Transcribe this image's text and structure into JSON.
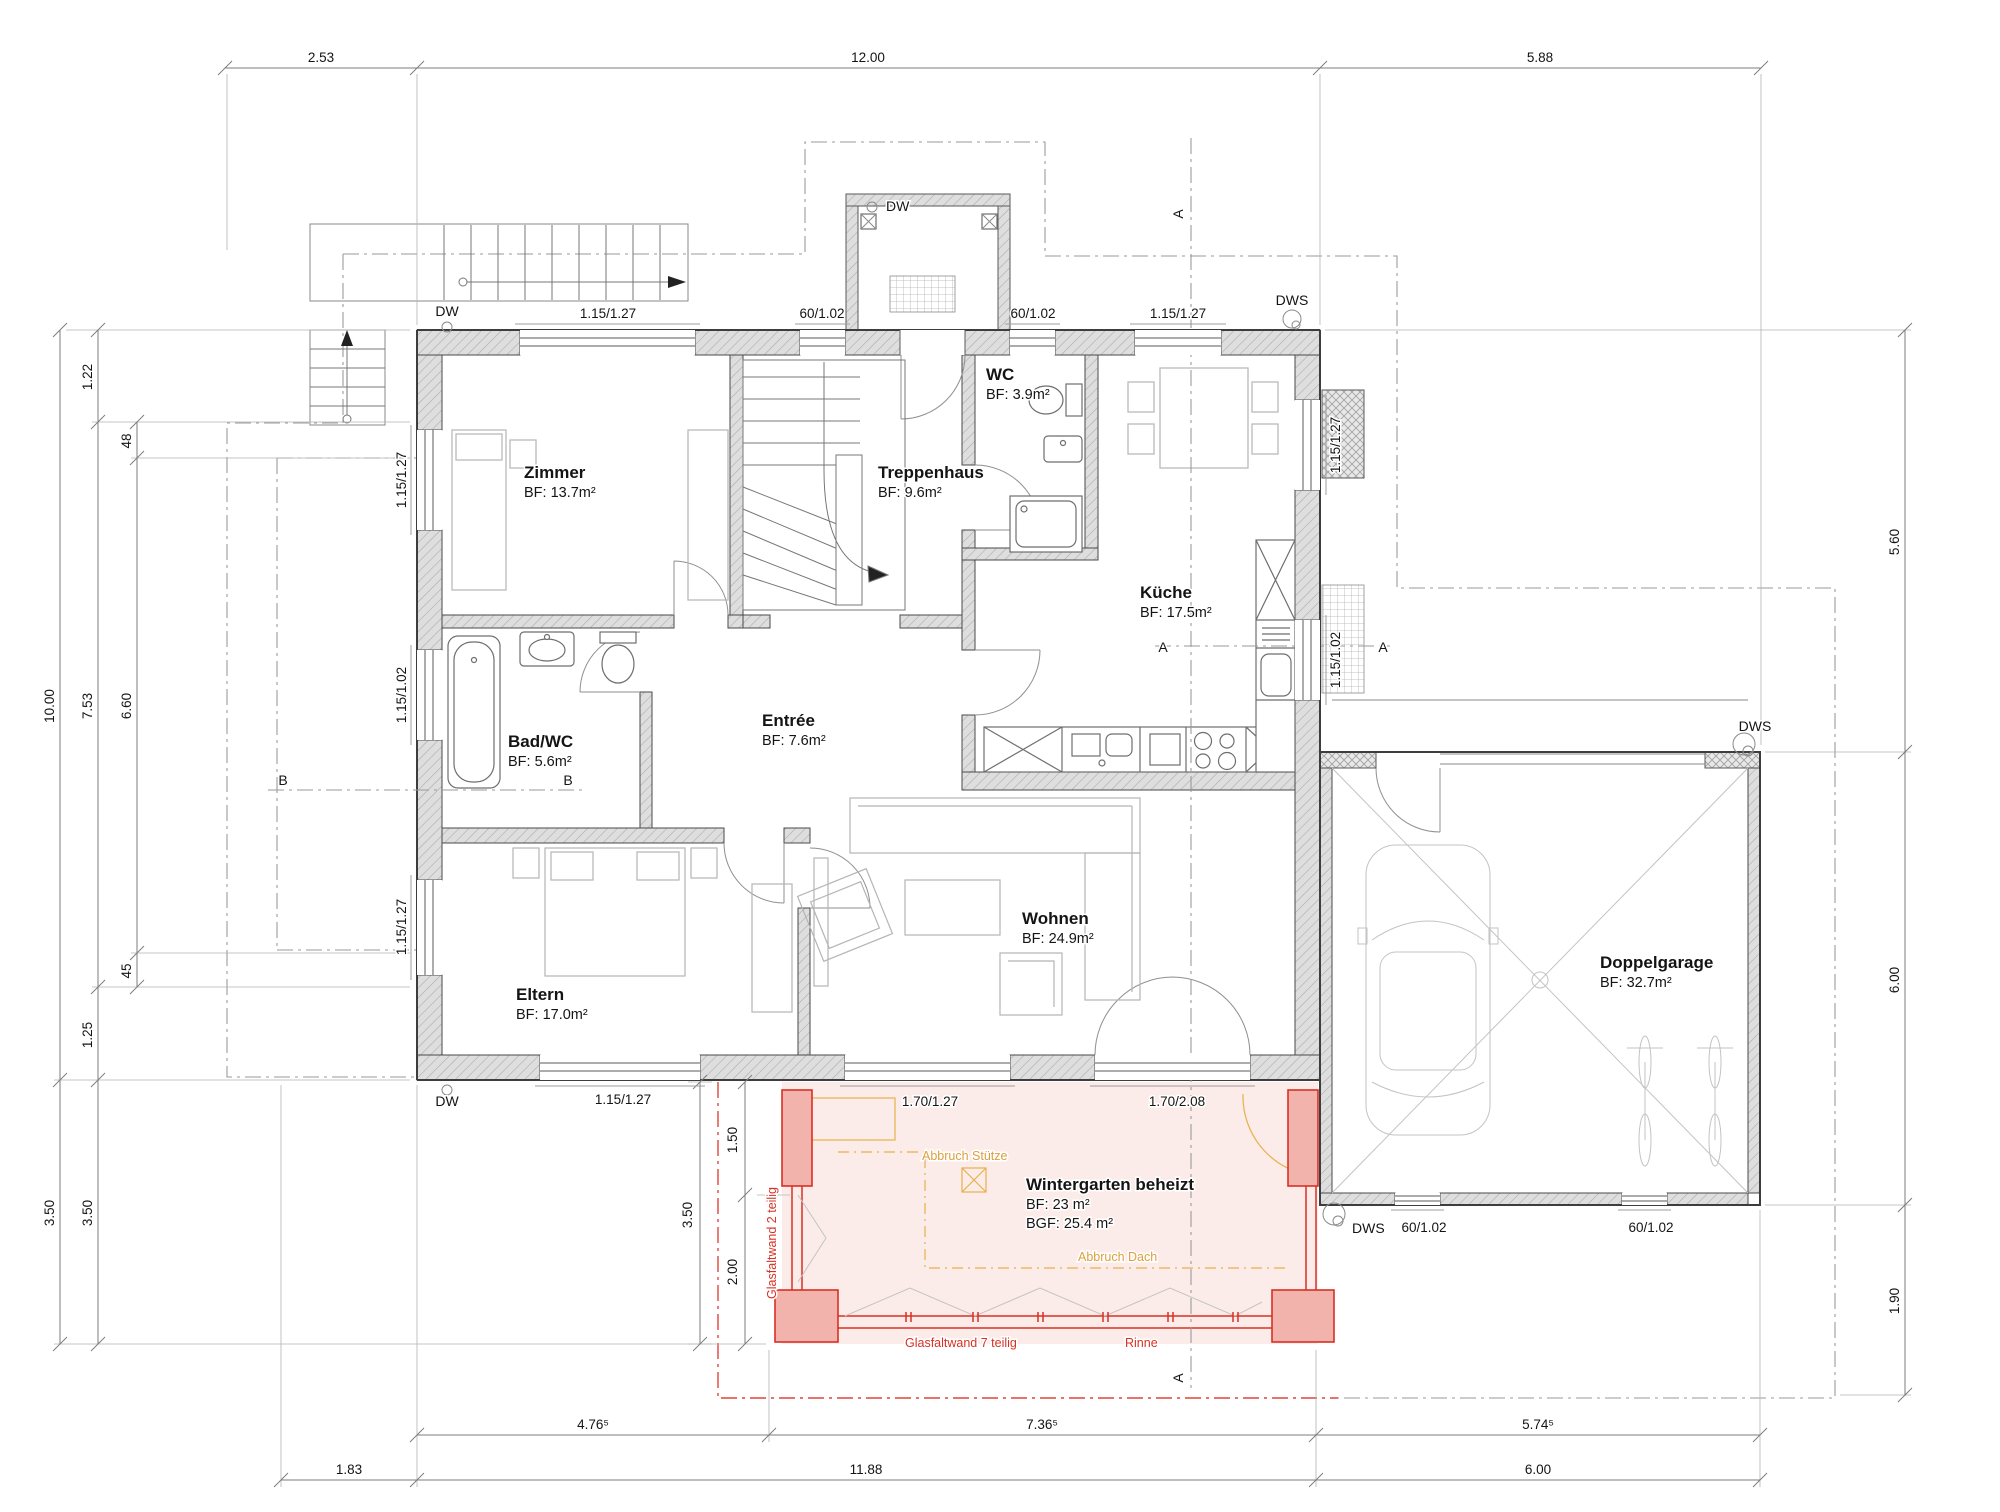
{
  "meta": {
    "drawing_type": "floor-plan",
    "language": "de"
  },
  "palette": {
    "background": "#ffffff",
    "line": "#7d7d7d",
    "wall_edge": "#3d3d3d",
    "text": "#141414",
    "accent_red": "#d93025",
    "accent_red_fill": "#f2b3ad",
    "accent_pink_fill": "#fceae7",
    "accent_orange": "#e7b04a"
  },
  "rooms": [
    {
      "id": "zimmer",
      "name": "Zimmer",
      "area": "BF: 13.7m²",
      "x": 524,
      "y": 478
    },
    {
      "id": "treppenhaus",
      "name": "Treppenhaus",
      "area": "BF: 9.6m²",
      "x": 878,
      "y": 478
    },
    {
      "id": "wc",
      "name": "WC",
      "area": "BF: 3.9m²",
      "x": 986,
      "y": 380
    },
    {
      "id": "kueche",
      "name": "Küche",
      "area": "BF: 17.5m²",
      "x": 1140,
      "y": 598
    },
    {
      "id": "bad-wc",
      "name": "Bad/WC",
      "area": "BF: 5.6m²",
      "x": 508,
      "y": 747
    },
    {
      "id": "entree",
      "name": "Entrée",
      "area": "BF: 7.6m²",
      "x": 762,
      "y": 726
    },
    {
      "id": "eltern",
      "name": "Eltern",
      "area": "BF: 17.0m²",
      "x": 516,
      "y": 1000
    },
    {
      "id": "wohnen",
      "name": "Wohnen",
      "area": "BF: 24.9m²",
      "x": 1022,
      "y": 924
    },
    {
      "id": "doppelgarage",
      "name": "Doppelgarage",
      "area": "BF: 32.7m²",
      "x": 1600,
      "y": 968
    },
    {
      "id": "wintergarten",
      "name": "Wintergarten beheizt",
      "area": "BF: 23 m²",
      "area2": "BGF: 25.4 m²",
      "x": 1026,
      "y": 1190
    }
  ],
  "dim_chains": [
    {
      "o": "h",
      "c": 68,
      "a": 225,
      "b": 1761,
      "ticks": [
        225,
        417,
        1320,
        1761
      ]
    },
    {
      "o": "h",
      "c": 1435,
      "a": 417,
      "b": 1760,
      "ticks": [
        417,
        769,
        1316,
        1760
      ]
    },
    {
      "o": "h",
      "c": 1480,
      "a": 281,
      "b": 1760,
      "ticks": [
        281,
        417,
        1316,
        1760
      ]
    },
    {
      "o": "v",
      "c": 60,
      "a": 330,
      "b": 1344,
      "ticks": [
        330,
        1080,
        1344
      ]
    },
    {
      "o": "v",
      "c": 98,
      "a": 330,
      "b": 1344,
      "ticks": [
        330,
        422,
        987,
        1080,
        1344
      ]
    },
    {
      "o": "v",
      "c": 137,
      "a": 422,
      "b": 987,
      "ticks": [
        422,
        458,
        953,
        987
      ]
    },
    {
      "o": "v",
      "c": 1905,
      "a": 330,
      "b": 1395,
      "ticks": [
        330,
        752,
        1205,
        1395
      ]
    },
    {
      "o": "v",
      "c": 700,
      "a": 1082,
      "b": 1344,
      "ticks": [
        1082,
        1344
      ]
    },
    {
      "o": "v",
      "c": 745,
      "a": 1082,
      "b": 1344,
      "ticks": [
        1082,
        1195,
        1344
      ]
    }
  ],
  "dim_texts": [
    {
      "t": "2.53",
      "x": 321,
      "y": 62
    },
    {
      "t": "12.00",
      "x": 868,
      "y": 62
    },
    {
      "t": "5.88",
      "x": 1540,
      "y": 62
    },
    {
      "t": "10.00",
      "x": 54,
      "y": 706,
      "rot": -90
    },
    {
      "t": "7.53",
      "x": 92,
      "y": 706,
      "rot": -90
    },
    {
      "t": "6.60",
      "x": 131,
      "y": 706,
      "rot": -90
    },
    {
      "t": "1.22",
      "x": 92,
      "y": 377,
      "rot": -90
    },
    {
      "t": "48",
      "x": 131,
      "y": 441,
      "rot": -90
    },
    {
      "t": "45",
      "x": 131,
      "y": 971,
      "rot": -90
    },
    {
      "t": "1.25",
      "x": 92,
      "y": 1035,
      "rot": -90
    },
    {
      "t": "3.50",
      "x": 54,
      "y": 1213,
      "rot": -90
    },
    {
      "t": "3.50",
      "x": 92,
      "y": 1213,
      "rot": -90
    },
    {
      "t": "5.60",
      "x": 1899,
      "y": 542,
      "rot": -90
    },
    {
      "t": "6.00",
      "x": 1899,
      "y": 980,
      "rot": -90
    },
    {
      "t": "1.90",
      "x": 1899,
      "y": 1301,
      "rot": -90
    },
    {
      "t": "4.76⁵",
      "x": 593,
      "y": 1429
    },
    {
      "t": "7.36⁵",
      "x": 1042,
      "y": 1429
    },
    {
      "t": "5.74⁵",
      "x": 1538,
      "y": 1429
    },
    {
      "t": "1.83",
      "x": 349,
      "y": 1474
    },
    {
      "t": "11.88",
      "x": 866,
      "y": 1474
    },
    {
      "t": "6.00",
      "x": 1538,
      "y": 1474
    },
    {
      "t": "1.50",
      "x": 737,
      "y": 1140,
      "rot": -90
    },
    {
      "t": "2.00",
      "x": 737,
      "y": 1272,
      "rot": -90
    },
    {
      "t": "3.50",
      "x": 692,
      "y": 1215,
      "rot": -90
    }
  ],
  "opening_texts": [
    {
      "t": "1.15/1.27",
      "x": 608,
      "y": 318
    },
    {
      "t": "60/1.02",
      "x": 822,
      "y": 318
    },
    {
      "t": "60/1.02",
      "x": 1033,
      "y": 318
    },
    {
      "t": "1.15/1.27",
      "x": 1178,
      "y": 318
    },
    {
      "t": "1.15/1.27",
      "x": 406,
      "y": 480,
      "rot": -90
    },
    {
      "t": "1.15/1.02",
      "x": 406,
      "y": 695,
      "rot": -90
    },
    {
      "t": "1.15/1.27",
      "x": 406,
      "y": 927,
      "rot": -90
    },
    {
      "t": "1.15/1.27",
      "x": 1340,
      "y": 445,
      "rot": -90
    },
    {
      "t": "1.15/1.02",
      "x": 1340,
      "y": 660,
      "rot": -90
    },
    {
      "t": "1.15/1.27",
      "x": 623,
      "y": 1104
    },
    {
      "t": "1.70/1.27",
      "x": 930,
      "y": 1106
    },
    {
      "t": "1.70/2.08",
      "x": 1177,
      "y": 1106
    },
    {
      "t": "60/1.02",
      "x": 1424,
      "y": 1232
    },
    {
      "t": "60/1.02",
      "x": 1651,
      "y": 1232
    }
  ],
  "marker_texts": [
    {
      "t": "DW",
      "x": 447,
      "y": 316
    },
    {
      "t": "DW",
      "x": 886,
      "y": 211,
      "anchor": "start"
    },
    {
      "t": "DW",
      "x": 447,
      "y": 1106
    },
    {
      "t": "DWS",
      "x": 1292,
      "y": 305
    },
    {
      "t": "DWS",
      "x": 1755,
      "y": 731
    },
    {
      "t": "DWS",
      "x": 1352,
      "y": 1233,
      "anchor": "start"
    },
    {
      "t": "A",
      "x": 1163,
      "y": 652
    },
    {
      "t": "A",
      "x": 1383,
      "y": 652
    },
    {
      "t": "A",
      "x": 1183,
      "y": 214,
      "rot": -90
    },
    {
      "t": "A",
      "x": 1183,
      "y": 1378,
      "rot": -90
    },
    {
      "t": "B",
      "x": 283,
      "y": 785
    },
    {
      "t": "B",
      "x": 568,
      "y": 785
    }
  ],
  "red_texts": [
    {
      "t": "Glasfaltwand 2 teilig",
      "x": 776,
      "y": 1243,
      "rot": -90
    },
    {
      "t": "Glasfaltwand 7 teilig",
      "x": 905,
      "y": 1347,
      "anchor": "start"
    },
    {
      "t": "Rinne",
      "x": 1125,
      "y": 1347,
      "anchor": "start"
    }
  ],
  "orange_texts": [
    {
      "t": "Abbruch Stütze",
      "x": 922,
      "y": 1160,
      "anchor": "start"
    },
    {
      "t": "Abbruch Dach",
      "x": 1078,
      "y": 1261,
      "anchor": "start"
    }
  ],
  "windows": {
    "top": [
      [
        520,
        695
      ],
      [
        800,
        845
      ],
      [
        1010,
        1055
      ],
      [
        1135,
        1221
      ]
    ],
    "left": [
      [
        430,
        530
      ],
      [
        650,
        740
      ],
      [
        880,
        975
      ]
    ],
    "right": [
      [
        400,
        490
      ],
      [
        620,
        700
      ]
    ],
    "bottom": [
      [
        540,
        700
      ],
      [
        845,
        1010
      ],
      [
        1095,
        1250
      ]
    ],
    "gbot": [
      [
        1395,
        1440
      ],
      [
        1622,
        1667
      ]
    ]
  }
}
